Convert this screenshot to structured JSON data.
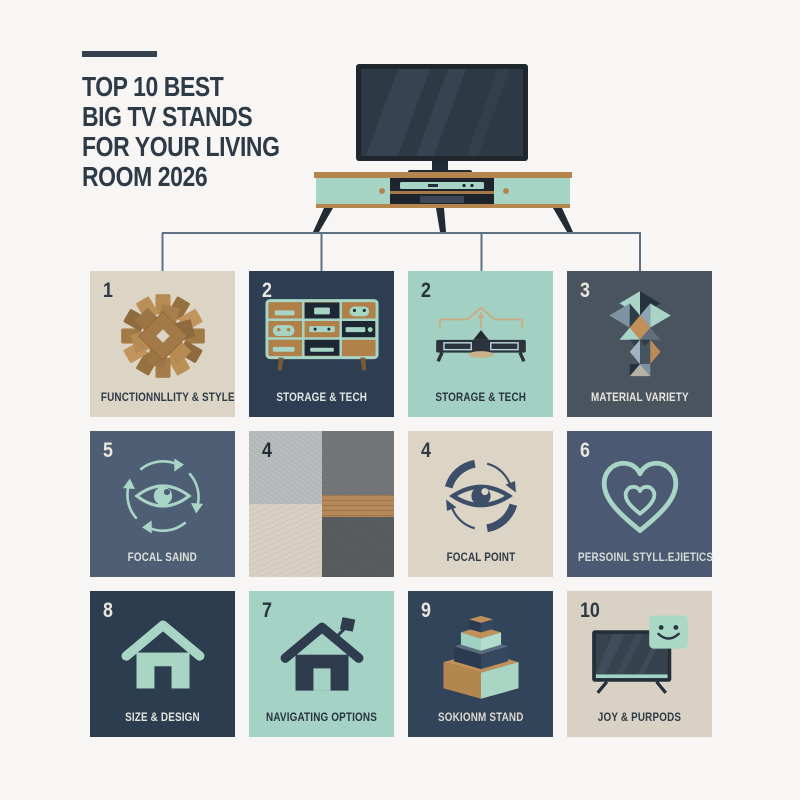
{
  "page": {
    "background": "#f7f6f4"
  },
  "header": {
    "accent_bar_color": "#36414f",
    "title_color": "#2f3a47",
    "title_lines": [
      "TOP 10 BEST",
      "BIG TV STANDS",
      "FOR YOUR LIVING",
      "ROOM 2026"
    ]
  },
  "hero": {
    "illustration": "flat-screen-tv-on-mint-wood-media-console",
    "colors": {
      "tv_frame": "#1f262e",
      "tv_screen": "#2d3944",
      "wood": "#b5854e",
      "mint": "#a6d5c5",
      "dark_panel": "#1d242d"
    }
  },
  "connectors": {
    "color": "#5f7082"
  },
  "tiles": [
    {
      "number": "1",
      "label": "FUNCTIONNLLITY & STYLE",
      "icon": "wood-parquet-starburst-icon",
      "bg": "#dcd5c6"
    },
    {
      "number": "2",
      "label": "STORAGE & TECH",
      "icon": "media-console-shelves-icon",
      "bg": "#2e3e52"
    },
    {
      "number": "2",
      "label": "STORAGE & TECH",
      "icon": "tv-stand-up-arrow-icon",
      "bg": "#a2d1c3"
    },
    {
      "number": "3",
      "label": "MATERIAL VARIETY",
      "icon": "triangle-mosaic-icon",
      "bg": "#49545f"
    },
    {
      "number": "5",
      "label": "FOCAL SAIND",
      "icon": "eye-cycle-arrows-icon",
      "bg": "#4d5e75"
    },
    {
      "number": "4",
      "label": "",
      "icon": "material-texture-swatches",
      "bg": "#b9bcbd"
    },
    {
      "number": "4",
      "label": "FOCAL POINT",
      "icon": "eye-cycle-arrows-icon",
      "bg": "#dcd5c6"
    },
    {
      "number": "6",
      "label": "PERSOINL STYLL.EJIETICS",
      "icon": "double-heart-icon",
      "bg": "#4b5a72"
    },
    {
      "number": "8",
      "label": "SIZE & DESIGN",
      "icon": "house-icon",
      "bg": "#2c3d50"
    },
    {
      "number": "7",
      "label": "NAVIGATING OPTIONS",
      "icon": "house-flag-icon",
      "bg": "#a4d2c4"
    },
    {
      "number": "9",
      "label": "SOKIONM STAND",
      "icon": "stacked-boxes-icon",
      "bg": "#32445a"
    },
    {
      "number": "10",
      "label": "JOY & PURPODS",
      "icon": "tv-smiley-icon",
      "bg": "#d9d2c4"
    }
  ]
}
